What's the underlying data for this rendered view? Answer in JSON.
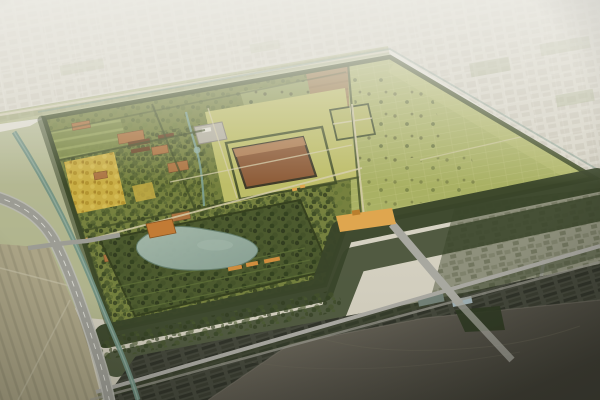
{
  "scene": {
    "description": "Aerial bird's-eye rendering of a vast walled archaeological heritage park: green excavation fields and orchards inside tree-lined ramparts, a central rammed-earth palace platform, a walled lake garden, a golden south gate causeway, a curving highway and canal on the west, hazy city grid fading to white in the distance, and a dark industrial riverfront in the foreground."
  },
  "regions": {
    "far-city": "hazy distant city grid",
    "site-enclosure": "walled heritage site",
    "east-field": "large eastern crop field",
    "north-brown-strip": "tilled earth strip",
    "palace-compound": "central palace precinct",
    "palace-platform": "rammed-earth palace foundation",
    "west-orchards": "western orchards and ruin plots",
    "golden-orchard": "golden ginkgo grove",
    "lake-garden": "walled lake garden",
    "lake": "garden lake",
    "south-gate": "gold south gate causeway",
    "highway": "western highway",
    "river-canal": "western canal",
    "south-forest-belt": "forest shelter belt",
    "east-town": "village east of the wall",
    "industrial-district": "dark warehouse district",
    "south-river": "foreground river",
    "railway": "railway and service road",
    "west-town": "low-rise town southwest"
  },
  "colors": {
    "haze-top": "#ecebe4",
    "haze-low": "#d7d3c4",
    "fog": "#edece6",
    "far-block": "#c6c2b3",
    "far-road": "#e2dfd4",
    "far-green": "#9aa478",
    "site-base": "#96a058",
    "east-field": "#a9b164",
    "east-field-light": "#bcc276",
    "grid-line": "#c6c885",
    "lawn": "#bdbd68",
    "brown-strip": "#9b7c4c",
    "orchard": "#76813f",
    "tree-dark": "#3a4723",
    "tree-mid": "#5c6b33",
    "gold-orchard": "#c9ae45",
    "gold-tree": "#b3942f",
    "earth-plot": "#ab7340",
    "roof-brown": "#6b4626",
    "platform": "#8d5b37",
    "platform-light": "#b28257",
    "wall-dark": "#414e28",
    "path-tan": "#d5cda9",
    "stream": "#7fa398",
    "river": "#6f9082",
    "river-light": "#a3b8ab",
    "lake": "#8aa296",
    "lake-light": "#a7bbad",
    "road-gray": "#9c9c94",
    "lane-white": "#e4e4dc",
    "gate-gold": "#dfa64f",
    "causeway": "#a8a8a0",
    "forest": "#39452a",
    "village": "#8e907c",
    "village-block": "#72765f",
    "industrial": "#45483c",
    "industrial-roof": "#2e3127",
    "beige-city": "#aba486",
    "beige-row": "#8f8a70",
    "water-light": "#7a7566",
    "water-dark": "#3e3d34",
    "blue-roof": "#9fb0b5"
  }
}
